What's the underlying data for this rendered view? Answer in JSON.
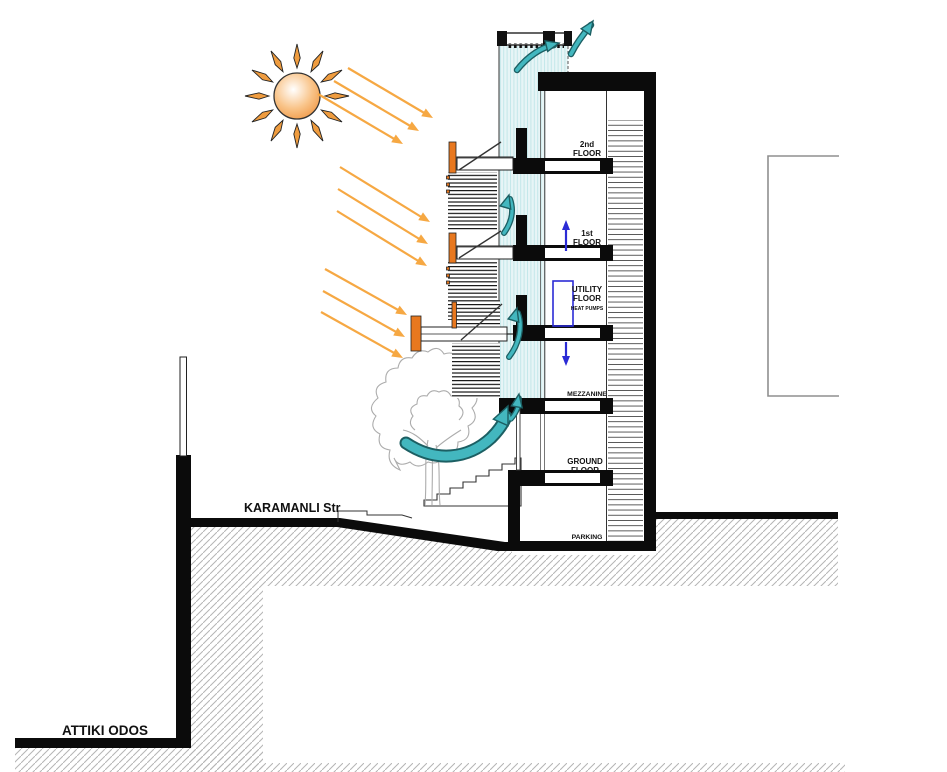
{
  "labels": {
    "street_upper": "KARAMANLI Str",
    "street_lower": "ATTIKI ODOS"
  },
  "floors": [
    {
      "line1": "2nd",
      "line2": "FLOOR"
    },
    {
      "line1": "1st",
      "line2": "FLOOR"
    },
    {
      "line1": "UTILITY",
      "line2": "FLOOR",
      "note": "HEAT PUMPS"
    },
    {
      "line1": "MEZZANINE"
    },
    {
      "line1": "GROUND",
      "line2": "FLOOR"
    },
    {
      "line1": "PARKING"
    }
  ],
  "colors": {
    "ink": "#111111",
    "accent_orange": "#E8781F",
    "solar_arrow": "#F6A843",
    "sun_mid": "#F9C489",
    "sun_edge": "#EF9440",
    "ray_fill": "#EF9C3F",
    "air_fill": "#43B7BF",
    "air_dark": "#1C5F63",
    "hvac_blue": "#2B2BD5",
    "cavity_bg": "#E7F5F6",
    "cavity_stripe": "#C3E7E9",
    "hatch_gray": "#B5B5B5",
    "tree_gray": "#ACACAC",
    "neighbor_gray": "#8F8F8F"
  }
}
